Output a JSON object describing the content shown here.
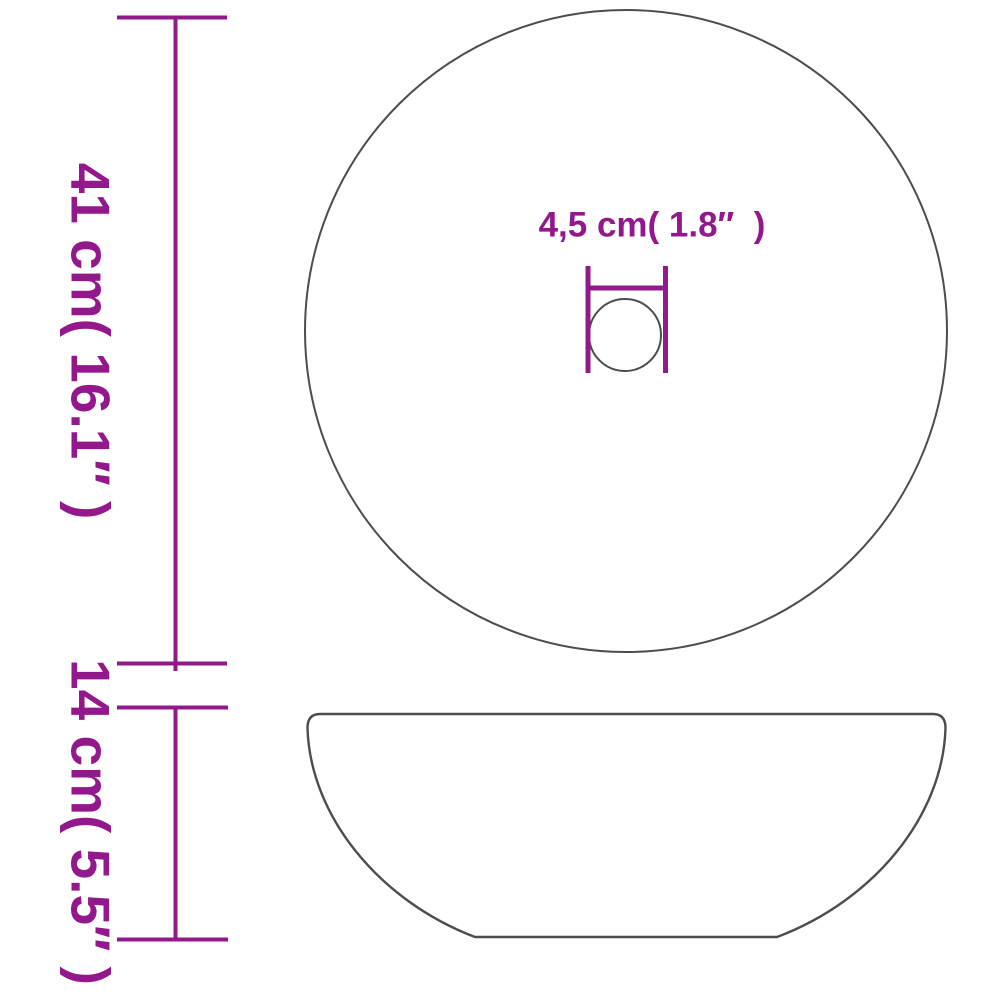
{
  "colors": {
    "accent": "#92188C",
    "outline": "#4D4D4D",
    "background": "#FFFFFF"
  },
  "diagram": {
    "type": "product-dimension-drawing",
    "subject": "round-countertop-basin",
    "diameter_label": "41 cm( 16.1″ )",
    "height_label": "14 cm( 5.5″ )",
    "drain_label": "4,5 cm( 1.8″  )"
  }
}
